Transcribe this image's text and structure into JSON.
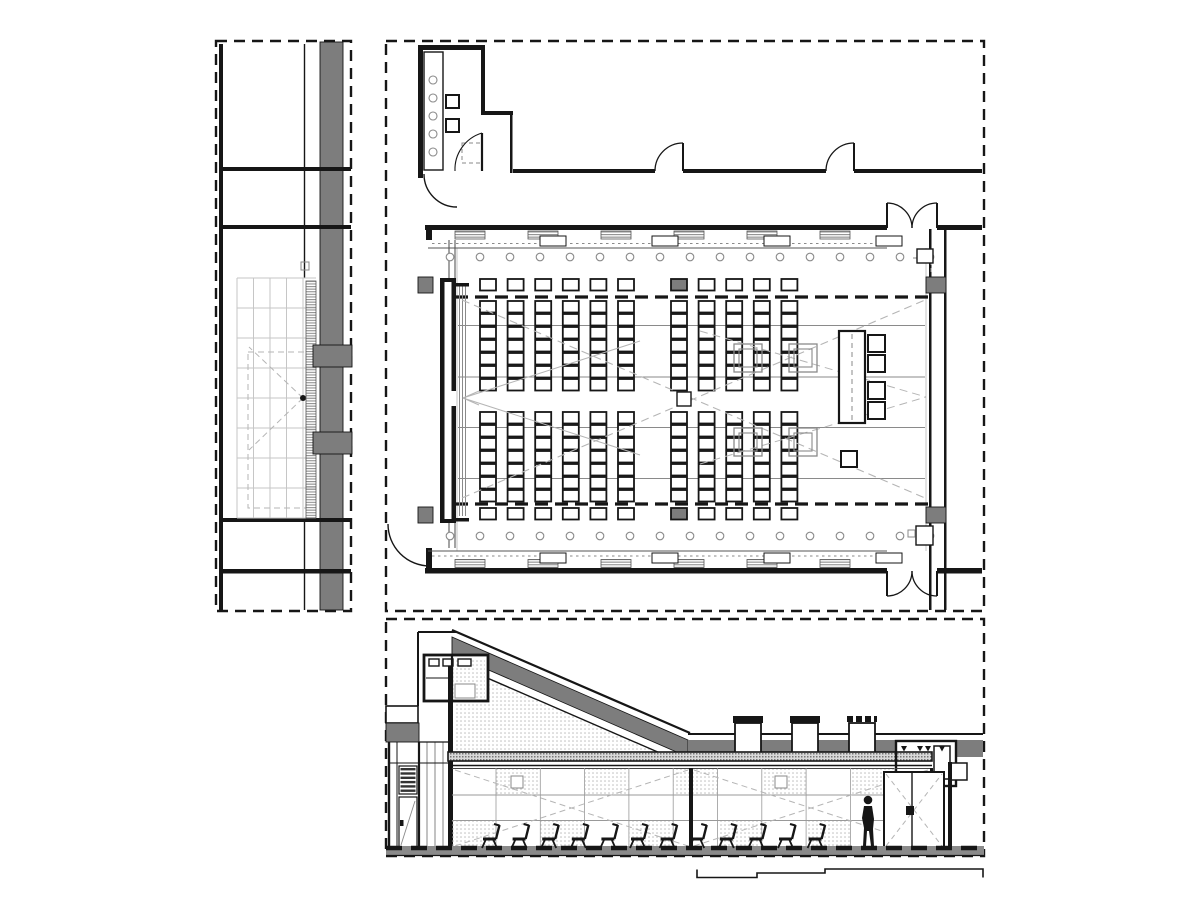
{
  "drawing": {
    "kind": "architectural-drawing",
    "subject": "auditorium / lecture hall",
    "views": [
      {
        "id": "detail-plan",
        "label": "wall-detail-plan-strip"
      },
      {
        "id": "floor-plan",
        "label": "auditorium-floor-plan"
      },
      {
        "id": "section",
        "label": "longitudinal-section"
      }
    ]
  },
  "colors": {
    "background": "#ffffff",
    "line": "#161616",
    "poche": "#7d7d7d",
    "mid_gray": "#8a8a8a",
    "faint": "#c6c6c6",
    "dash": "#b5b5b5",
    "texture_dot": "#b9b9b9",
    "hatch": "#8f8f8f"
  },
  "detail_plan": {
    "grid_columns": 5,
    "grid_rows": 9,
    "wall_tabs": 2
  },
  "floor_plan": {
    "seat_columns_left": 6,
    "seat_columns_right": 5,
    "seat_rows_top": 8,
    "seat_rows_bottom": 8,
    "gray_corner_seats": 2,
    "structural_columns": 4,
    "ceiling_lights_per_row": 17,
    "light_rows": 2,
    "soffit_hatch_panels_per_band": 6,
    "soffit_light_boxes_per_band": 4,
    "counter_circles": 5,
    "operator_chairs": 4,
    "floor_boxes": 4,
    "single_doors": 2,
    "double_doors": 2,
    "step_lines": 4,
    "screen_lines": 3
  },
  "section": {
    "audience_chairs": 12,
    "rooftop_units": 3,
    "wall_panel_joints": 10,
    "dotted_panels_top": 5,
    "dotted_panels_bottom": 5,
    "louver_slats": 6,
    "standing_figures": 1
  }
}
